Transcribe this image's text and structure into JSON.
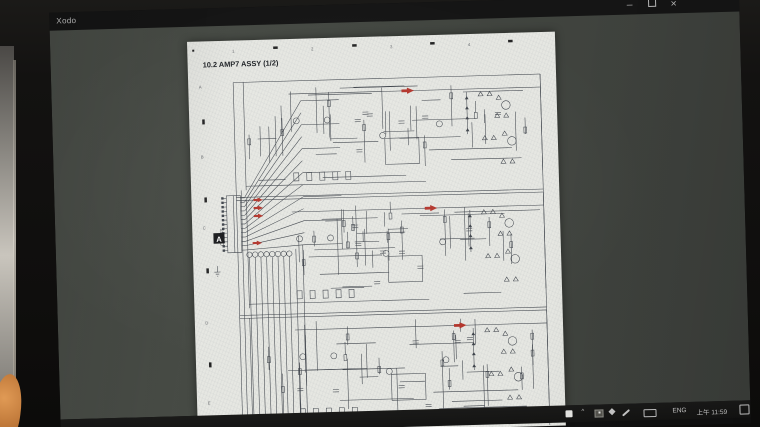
{
  "window": {
    "app_title": "Xodo",
    "minimize_glyph": "─",
    "close_glyph": "✕"
  },
  "viewer_page": {
    "heading": "10.2  AMP7 ASSY (1/2)",
    "zones_top": [
      "1",
      "2",
      "3",
      "4"
    ],
    "zones_left": [
      "A",
      "B",
      "C",
      "D",
      "E"
    ],
    "connector": {
      "marker": "A",
      "label": "CN2103",
      "pin_count": 13,
      "circle_count": 8
    },
    "channels": [
      {
        "y": 42,
        "arrow_x": 221,
        "seed": 11
      },
      {
        "y": 160,
        "arrow_x": 241,
        "seed": 27,
        "xmin": 60
      },
      {
        "y": 278,
        "arrow_x": 267,
        "seed": 43
      }
    ],
    "ink": "#3e434a",
    "red": "#b5342a",
    "paper": "#e6e7e2"
  },
  "taskbar": {
    "chevron": "^",
    "language": "ENG",
    "time": "上午 11:59"
  },
  "colors": {
    "bezel": "#131211",
    "titlebar": "#151515",
    "app_background": "#42463f",
    "taskbar_background": "#181817",
    "wall": "#c9c5bd",
    "orange_object": "#c0793a"
  }
}
